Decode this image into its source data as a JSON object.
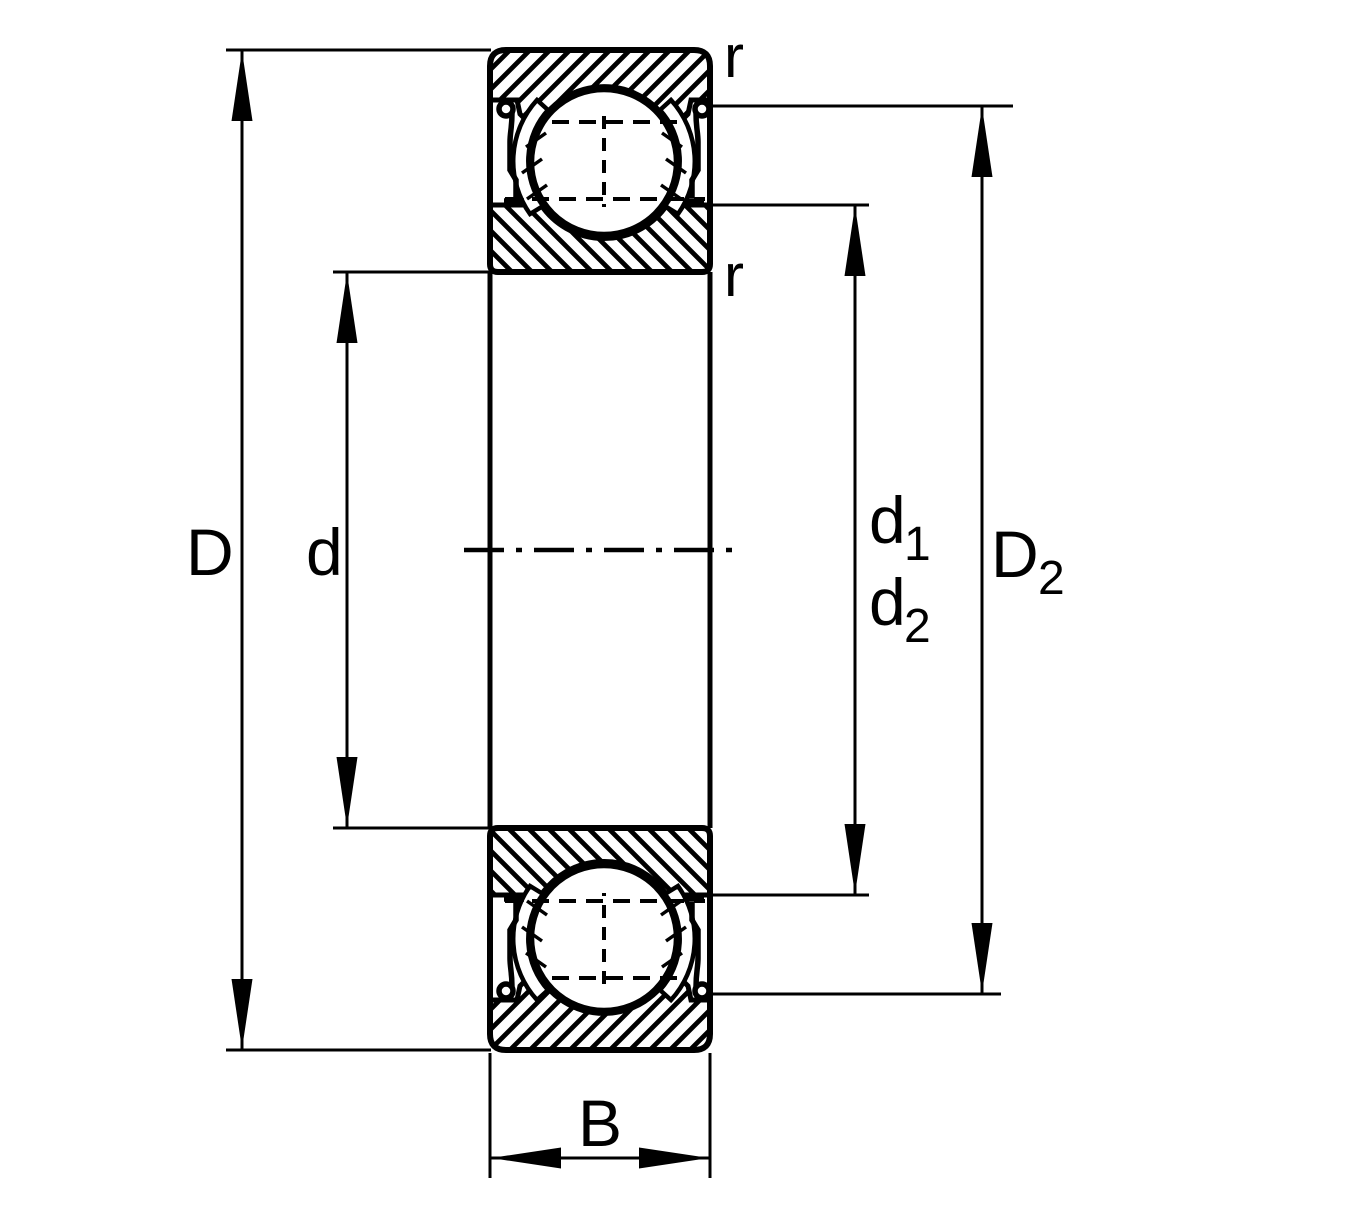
{
  "drawing": {
    "type": "bearing-cross-section-dimension-drawing",
    "colors": {
      "line": "#000000",
      "background": "#ffffff"
    },
    "labels": {
      "outer_diameter": "D",
      "bore_diameter": "d",
      "shoulder1_main": "d",
      "shoulder1_sub": "1",
      "shoulder2_main": "d",
      "shoulder2_sub": "2",
      "recess_main": "D",
      "recess_sub": "2",
      "width": "B",
      "chamfer_top": "r",
      "chamfer_mid": "r"
    }
  }
}
